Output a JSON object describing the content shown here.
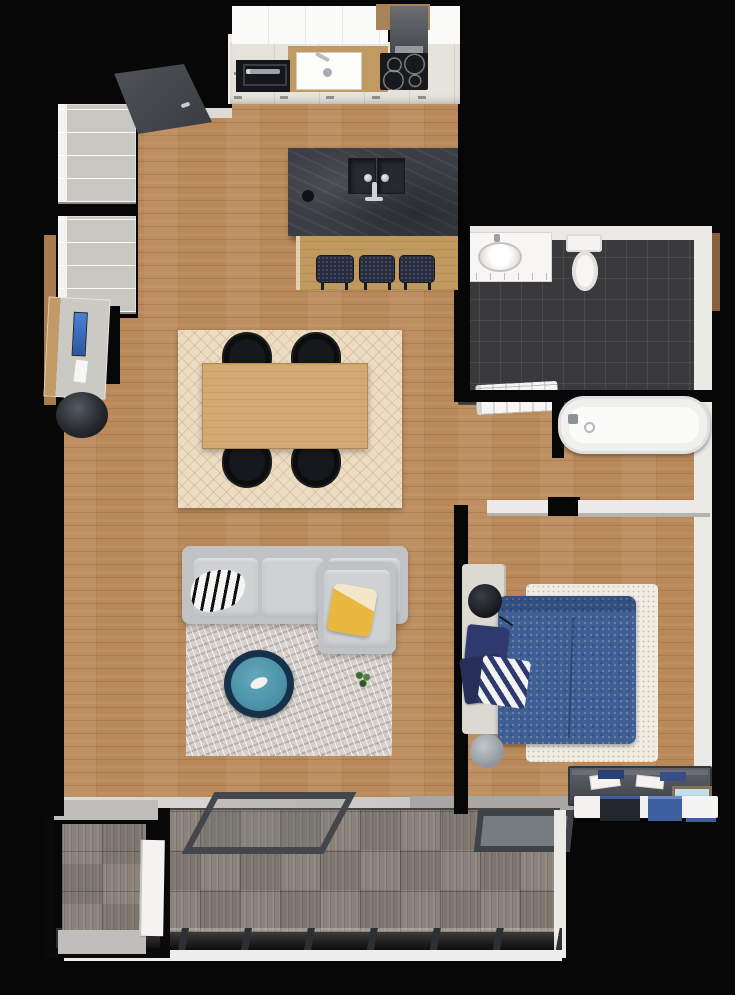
{
  "scene": {
    "kind": "3d-floor-plan-top-view",
    "background": "#000000",
    "rooms": [
      {
        "name": "kitchen-living-dining",
        "floor": "wood"
      },
      {
        "name": "bathroom",
        "floor": "dark-tile"
      },
      {
        "name": "hallway",
        "floor": "wood"
      },
      {
        "name": "bedroom",
        "floor": "wood"
      },
      {
        "name": "balcony",
        "floor": "gray-deck-tiles"
      },
      {
        "name": "storage-room",
        "floor": "gray-deck-tiles"
      }
    ],
    "furniture": {
      "kitchen": [
        "upper-cabinets",
        "range-hood",
        "cooktop-4-burners",
        "oven",
        "kitchen-sink",
        "kitchen-island-double-sink",
        "breakfast-bar",
        "bar-stool-1",
        "bar-stool-2",
        "bar-stool-3",
        "entry-door"
      ],
      "dining": [
        "dining-rug",
        "dining-table",
        "dining-chair-1",
        "dining-chair-2",
        "dining-chair-3",
        "dining-chair-4"
      ],
      "living": [
        "sectional-sofa",
        "chaise",
        "zebra-throw",
        "yellow-pillow",
        "living-rug",
        "teal-ottoman",
        "potted-plant",
        "desk",
        "desk-monitor",
        "desk-chair",
        "wardrobe-cabinet-1",
        "wardrobe-cabinet-2"
      ],
      "bathroom": [
        "vanity-with-sink",
        "toilet",
        "washing-machine",
        "bathtub"
      ],
      "bedroom": [
        "double-bed-blue-duvet",
        "pillow-navy-1",
        "pillow-navy-2",
        "pillow-chevron",
        "white-shag-rug",
        "nightstand-lamp-top",
        "nightstand-lamp-bottom",
        "dresser",
        "drawer-unit-with-boxes",
        "picture-frame",
        "wardrobe-strip-left",
        "wardrobe-strip-right"
      ],
      "balcony": [
        "deck-table-frame",
        "deck-tray",
        "railing",
        "storage-door"
      ]
    },
    "palette": {
      "wall_black": "#070707",
      "wall_white": "#eceae6",
      "wood_floor": "#b9895a",
      "deck": "#8b837b",
      "tile": "#3a3a3d",
      "counter_cream": "#e6e3dc",
      "island_slate": "#3b3f45",
      "bar_wood": "#c0995f",
      "table_wood": "#d3ab72",
      "chair_black": "#15181c",
      "stool_navy": "#262b3e",
      "dining_rug": "#ecdcc2",
      "sofa_gray": "#bfc3c5",
      "cushion_gray": "#ced2d3",
      "living_rug": "#d8d1cd",
      "ottoman_teal": "#4d93a8",
      "ottoman_ring": "#16324a",
      "pillow_yellow": "#e9b83e",
      "bed_blue": "#3f5f94",
      "bedroom_rug": "#f1ede5",
      "dresser_gray": "#4a4e54",
      "threshold_gray": "#a9a7a3",
      "railing_gray": "#9fa2a3",
      "door_dark": "#45494e"
    }
  }
}
